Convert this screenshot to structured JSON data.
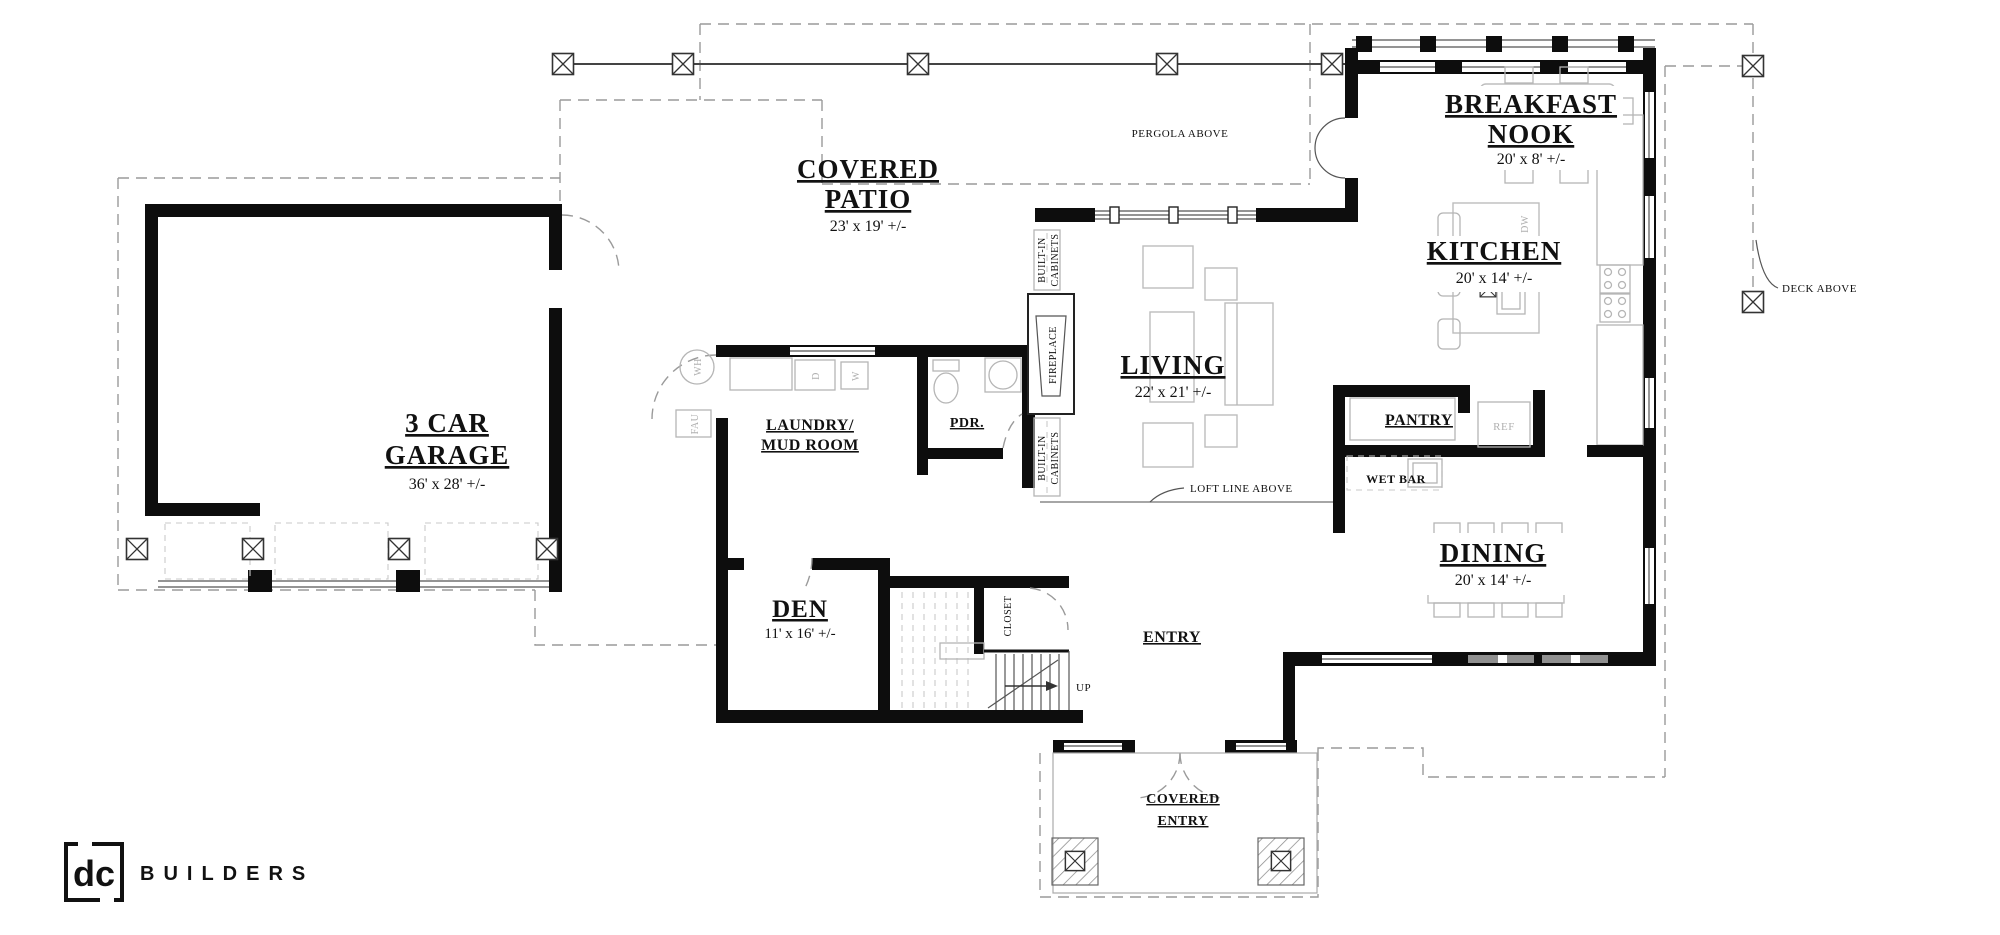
{
  "rooms": {
    "garage": {
      "line1": "3 CAR",
      "line2": "GARAGE",
      "dims": "36' x 28' +/-"
    },
    "covered_patio": {
      "line1": "COVERED",
      "line2": "PATIO",
      "dims": "23' x 19' +/-"
    },
    "breakfast_nook": {
      "line1": "BREAKFAST",
      "line2": "NOOK",
      "dims": "20' x 8' +/-"
    },
    "kitchen": {
      "name": "KITCHEN",
      "dims": "20' x 14' +/-"
    },
    "living": {
      "name": "LIVING",
      "dims": "22' x 21' +/-"
    },
    "dining": {
      "name": "DINING",
      "dims": "20' x 14' +/-"
    },
    "den": {
      "name": "DEN",
      "dims": "11' x 16' +/-"
    },
    "laundry": {
      "line1": "LAUNDRY/",
      "line2": "MUD ROOM"
    },
    "powder": {
      "name": "PDR."
    },
    "pantry": {
      "name": "PANTRY"
    },
    "wet_bar": {
      "name": "WET BAR"
    },
    "entry": {
      "name": "ENTRY"
    },
    "closet": {
      "name": "CLOSET"
    },
    "covered_entry": {
      "line1": "COVERED",
      "line2": "ENTRY"
    }
  },
  "annotations": {
    "pergola_above": "PERGOLA ABOVE",
    "deck_above": "DECK ABOVE",
    "loft_line_above": "LOFT LINE ABOVE",
    "up": "UP",
    "fireplace": "FIREPLACE",
    "built_in": "BUILT-IN",
    "cabinets": "CABINETS"
  },
  "fixtures": {
    "washer": "W",
    "dryer": "D",
    "dishwasher": "DW",
    "refrigerator": "REF",
    "water_heater": "WH",
    "furnace": "FAU"
  },
  "branding": {
    "monogram": "dc",
    "name": "BUILDERS"
  },
  "colors": {
    "wall": "#0d0d0d",
    "dashed_line": "#9a9a9a",
    "furniture_line": "#bdbdbd",
    "gray_label": "#b0b0b0",
    "background": "#ffffff"
  }
}
